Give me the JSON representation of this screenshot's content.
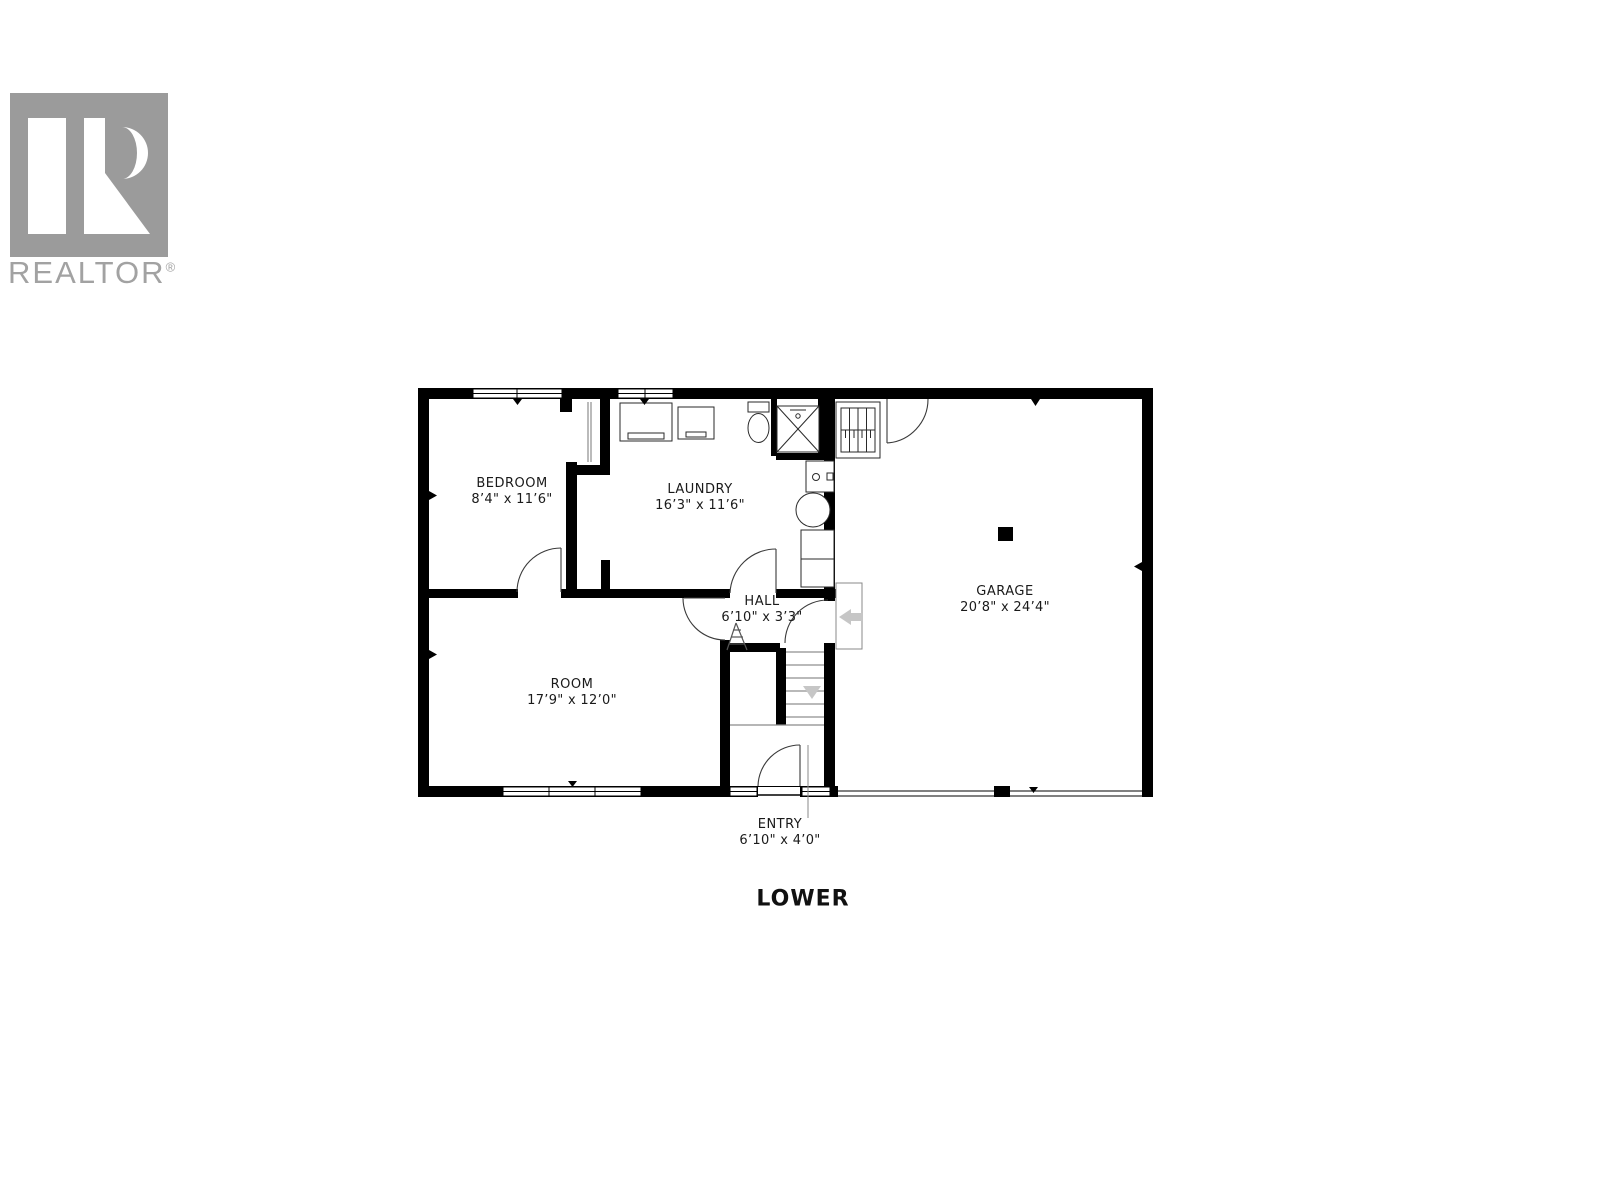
{
  "logo": {
    "brand": "REALTOR",
    "registered_mark": "®"
  },
  "floor_plan": {
    "title": "LOWER",
    "rooms": {
      "bedroom": {
        "name": "BEDROOM",
        "dims": "8’4\" x 11’6\""
      },
      "laundry": {
        "name": "LAUNDRY",
        "dims": "16’3\" x 11’6\""
      },
      "hall": {
        "name": "HALL",
        "dims": "6’10\" x 3’3\""
      },
      "room": {
        "name": "ROOM",
        "dims": "17’9\" x 12’0\""
      },
      "garage": {
        "name": "GARAGE",
        "dims": "20’8\" x 24’4\""
      },
      "entry": {
        "name": "ENTRY",
        "dims": "6’10\" x 4’0\""
      }
    },
    "colors": {
      "wall": "#000000",
      "stair_tread": "#b9b9b9",
      "gray_arrow": "#c6c6c6",
      "logo_gray": "#9b9b9b",
      "label_text": "#1a1a1a"
    }
  }
}
